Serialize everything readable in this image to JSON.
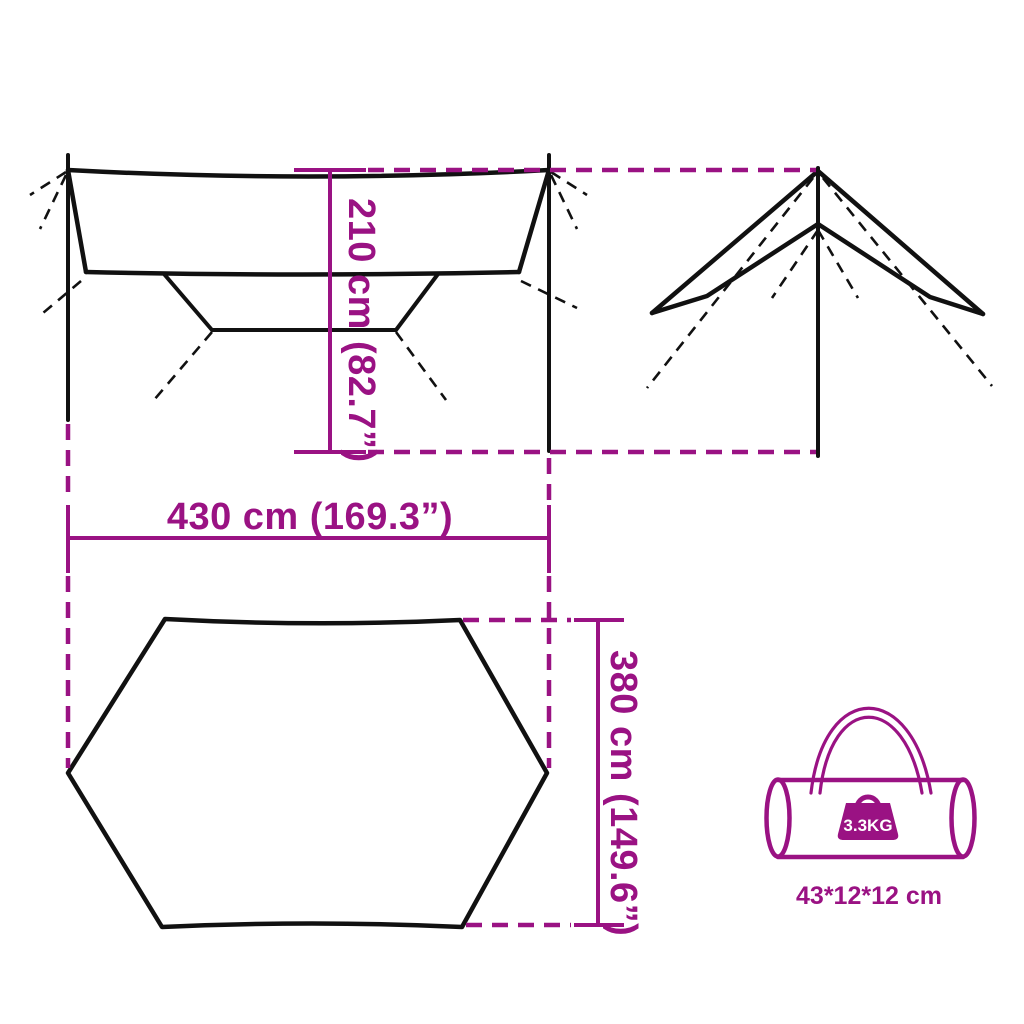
{
  "colors": {
    "accent": "#9A1283",
    "ink": "#111111",
    "background": "#ffffff"
  },
  "diagram": {
    "views": {
      "front": "tarp-front-view",
      "side": "tarp-side-view",
      "top": "tarp-top-view-hexagon"
    },
    "dimensions": {
      "height": {
        "label": "210 cm (82.7”)"
      },
      "width": {
        "label": "430 cm (169.3”)"
      },
      "depth": {
        "label": "380 cm (149.6”)"
      }
    },
    "bag": {
      "weight_label": "3.3KG",
      "size_label": "43*12*12 cm",
      "icons": [
        "carry-bag-icon",
        "weight-icon"
      ]
    }
  }
}
